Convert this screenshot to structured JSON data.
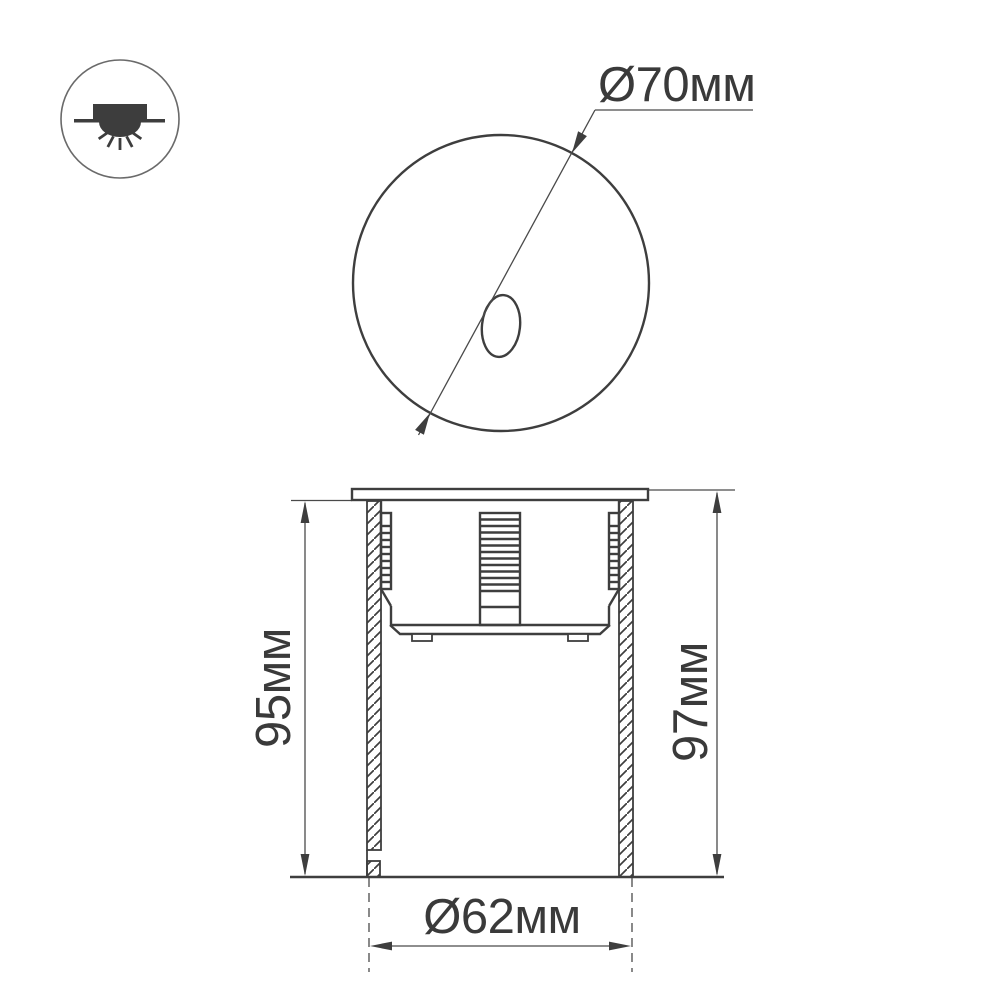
{
  "legend": {
    "icon": "recessed-downlight-icon"
  },
  "front_view": {
    "diameter_label": "Ø70мм"
  },
  "section_view": {
    "depth_left_label": "95мм",
    "depth_right_label": "97мм",
    "cutout_diameter_label": "Ø62мм"
  },
  "colors": {
    "background": "#ffffff",
    "line": "#3e3e3e",
    "dimension_line": "#4a4a4a",
    "text": "#3a3a3a",
    "icon_glyph": "#3d3d3d",
    "icon_ring": "#6a6a6a"
  }
}
